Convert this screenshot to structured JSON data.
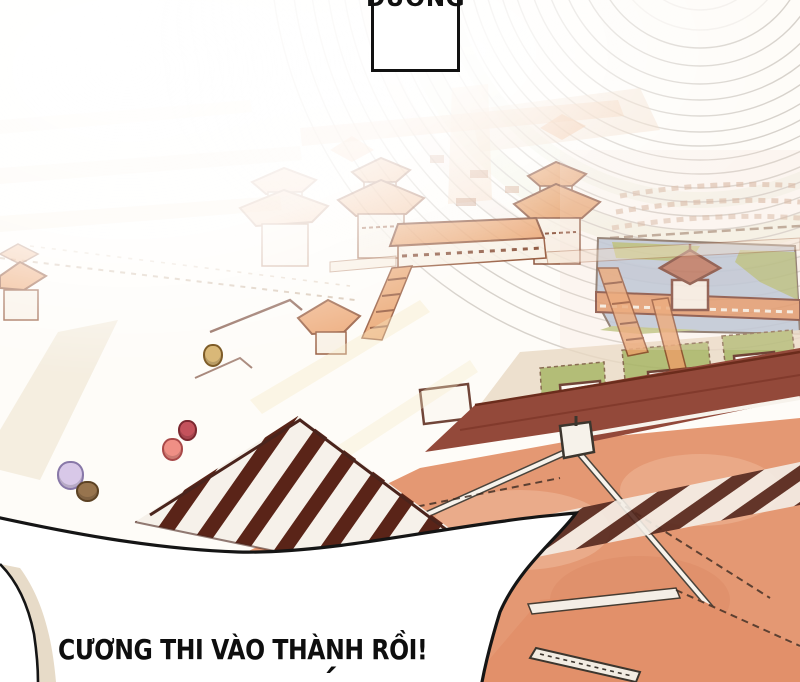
{
  "page": {
    "kind": "comic-panel",
    "speech_box": {
      "text": "DƯƠNG"
    },
    "bottom_bubble": {
      "text": "CƯƠNG THI VÀO THÀNH RỒI!",
      "second_line_partial": "´"
    },
    "scene": {
      "figures": [
        {
          "name": "figure-tan",
          "x": 211,
          "y": 353,
          "w": 16,
          "h": 19,
          "color": "#d9b878",
          "outline": "#7e5c28"
        },
        {
          "name": "figure-crimson",
          "x": 185,
          "y": 428,
          "w": 15,
          "h": 17,
          "color": "#c4525c",
          "outline": "#7c2830"
        },
        {
          "name": "figure-salmon",
          "x": 170,
          "y": 447,
          "w": 17,
          "h": 19,
          "color": "#ef8f85",
          "outline": "#a84848"
        },
        {
          "name": "figure-lavender",
          "x": 68,
          "y": 473,
          "w": 23,
          "h": 25,
          "color": "#d8c8e8",
          "outline": "#8878a8"
        },
        {
          "name": "figure-brown",
          "x": 85,
          "y": 489,
          "w": 19,
          "h": 17,
          "color": "#97744e",
          "outline": "#5c4224"
        }
      ],
      "colors": {
        "ink": "#151515",
        "roof_orange": "#e69a60",
        "roof_outline": "#7a3a20",
        "foreground_roof": "#e49873",
        "dark_roof_band": "#93493a",
        "pond_blue": "#b3c2d6",
        "lawn_green": "#a9b566",
        "causeway_orange": "#dd8c58",
        "floor_beige": "#e7dbc8",
        "courtyard_white": "#fdfbf7"
      }
    }
  }
}
